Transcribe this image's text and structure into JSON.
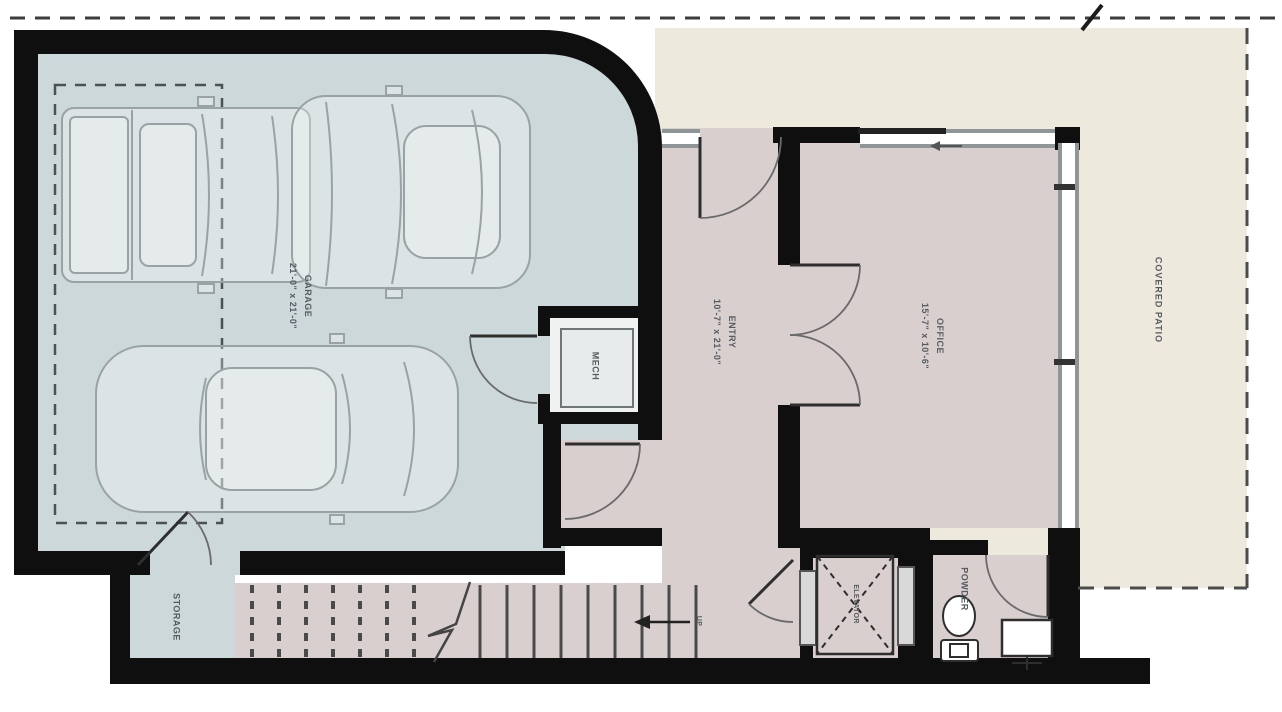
{
  "plan": {
    "type": "architectural-floor-plan",
    "colors": {
      "wall": "#0f0f0f",
      "garage_floor": "#cdd8da",
      "living_floor": "#d9cfce",
      "patio_floor": "#ede9dd",
      "label_text": "#565b61"
    },
    "rooms": {
      "garage": {
        "label": "GARAGE",
        "dims": "21'-0\" x 21'-0\""
      },
      "entry": {
        "label": "ENTRY",
        "dims": "10'-7\" x 21'-0\""
      },
      "office": {
        "label": "OFFICE",
        "dims": "15'-7\" x 10'-6\""
      },
      "mech": {
        "label": "MECH"
      },
      "storage": {
        "label": "STORAGE"
      },
      "elevator": {
        "label": "ELEVATOR"
      },
      "powder": {
        "label": "POWDER"
      },
      "covered_patio": {
        "label": "COVERED PATIO"
      },
      "stairs": {
        "up_label": "UP"
      }
    }
  }
}
